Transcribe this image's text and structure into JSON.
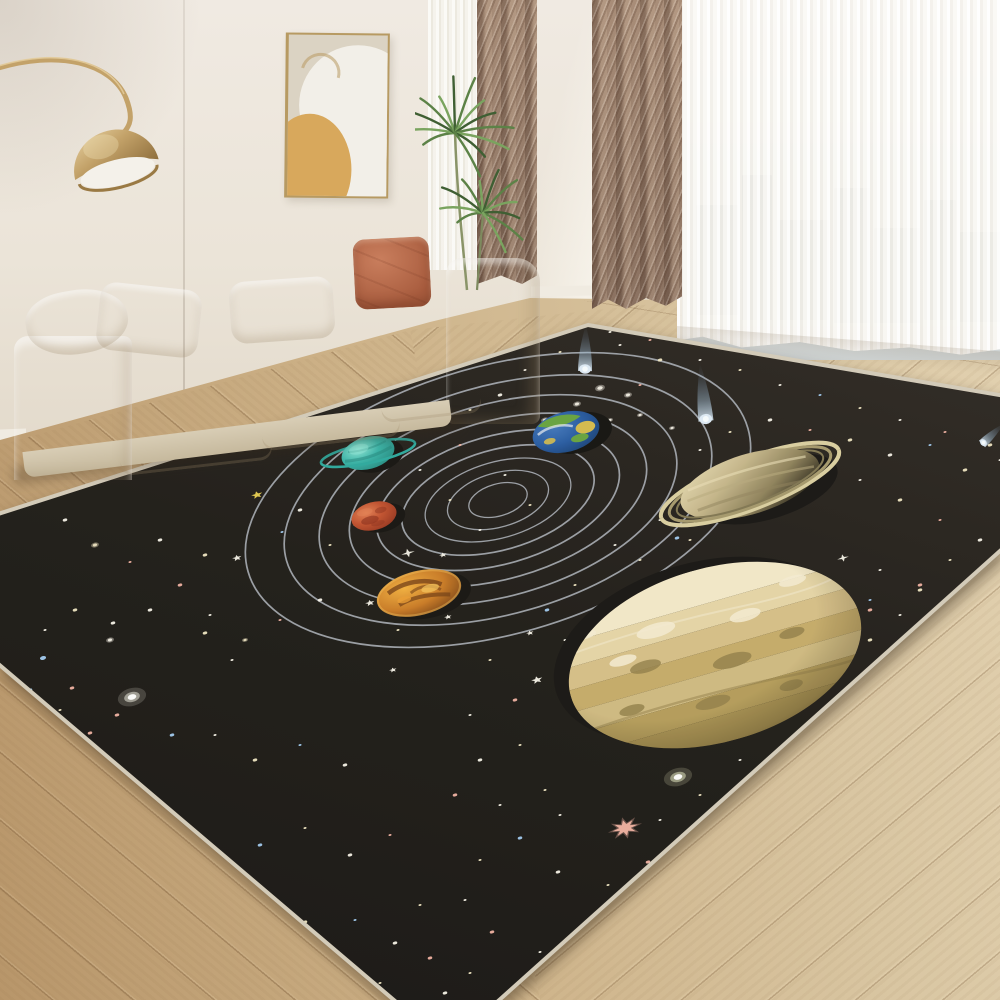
{
  "scene": {
    "kind": "product-photo",
    "subject": "solar-system area rug in a living room",
    "width": 1000,
    "height": 1000
  },
  "palette": {
    "wall1": "#f0eae2",
    "wall2": "#ebe4d8",
    "wall3": "#e2d9ca",
    "baseboard": "#f0ebe1",
    "floorL": "#b8966a",
    "floorM": "#cdb288",
    "floorR": "#d9c6a2",
    "curt1": "#a88d78",
    "curt2": "#8a7160",
    "sheerW": "#f7f5f0",
    "city": "#9aa4ad",
    "sky": "#e9eae8",
    "sofa1": "#f3edе0",
    "sofa2": "#e8e0cd",
    "sofa3": "#d8cdb5",
    "terra1": "#c97e5d",
    "terra2": "#a85c3e",
    "artBg": "#dbd3c3",
    "artWhite": "#f2efe8",
    "artMustard": "#d8a85c",
    "artFrame": "#b79a62",
    "gold1": "#c3a269",
    "gold2": "#8f6f3d",
    "gold3": "#e6d0a0",
    "plant1": "#5c8247",
    "plant2": "#7aa45f",
    "plant3": "#3f5f33"
  },
  "city_buildings": [
    {
      "x": 14,
      "y": 135,
      "w": 42,
      "h": 110
    },
    {
      "x": 60,
      "y": 105,
      "w": 30,
      "h": 145
    },
    {
      "x": 95,
      "y": 150,
      "w": 52,
      "h": 100
    },
    {
      "x": 152,
      "y": 118,
      "w": 36,
      "h": 135
    },
    {
      "x": 192,
      "y": 158,
      "w": 46,
      "h": 95
    },
    {
      "x": 242,
      "y": 130,
      "w": 32,
      "h": 120
    },
    {
      "x": 278,
      "y": 162,
      "w": 40,
      "h": 90
    }
  ],
  "rug": {
    "polygon": [
      [
        588,
        325
      ],
      [
        1146,
        420
      ],
      [
        448,
        1046
      ],
      [
        -130,
        555
      ]
    ],
    "bg_top": "#2a2520",
    "bg_mid": "#1c1914",
    "bg_bot": "#131110",
    "edge_color": "#d3cbb9",
    "edge_width": 4,
    "orbits": {
      "cx": 498,
      "cy": 500,
      "rot": -16,
      "stroke": "#a9aeb6",
      "rings": [
        [
          30,
          16
        ],
        [
          52,
          27
        ],
        [
          75,
          38
        ],
        [
          99,
          50
        ],
        [
          125,
          64
        ],
        [
          153,
          79
        ],
        [
          184,
          96
        ],
        [
          220,
          114
        ],
        [
          260,
          134
        ]
      ]
    },
    "star_colors": {
      "w": "#f7f3e8",
      "c": "#efe6c2",
      "p": "#f0b0a0",
      "b": "#9fc9ef",
      "y": "#e9cf4e",
      "g": "#eef2c9"
    },
    "stars": [
      [
        113,
        623,
        3,
        "w",
        "d"
      ],
      [
        43,
        658,
        4,
        "b",
        "d"
      ],
      [
        72,
        688,
        3,
        "p",
        "d"
      ],
      [
        132,
        697,
        8,
        "w",
        "g"
      ],
      [
        117,
        715,
        3,
        "p",
        "d"
      ],
      [
        172,
        735,
        3,
        "b",
        "d"
      ],
      [
        205,
        633,
        3,
        "c",
        "d"
      ],
      [
        232,
        660,
        2,
        "w",
        "d"
      ],
      [
        110,
        640,
        4,
        "w",
        "b"
      ],
      [
        65,
        520,
        3,
        "w",
        "d"
      ],
      [
        95,
        545,
        4,
        "c",
        "b"
      ],
      [
        130,
        562,
        2,
        "p",
        "d"
      ],
      [
        160,
        540,
        3,
        "w",
        "d"
      ],
      [
        205,
        555,
        3,
        "c",
        "d"
      ],
      [
        237,
        558,
        5,
        "w",
        "s5"
      ],
      [
        257,
        495,
        6,
        "y",
        "s5"
      ],
      [
        282,
        532,
        2,
        "b",
        "d"
      ],
      [
        300,
        510,
        3,
        "w",
        "d"
      ],
      [
        330,
        545,
        2,
        "c",
        "d"
      ],
      [
        355,
        525,
        2,
        "w",
        "d"
      ],
      [
        180,
        585,
        3,
        "p",
        "d"
      ],
      [
        150,
        610,
        3,
        "w",
        "d"
      ],
      [
        75,
        610,
        3,
        "c",
        "d"
      ],
      [
        45,
        630,
        2,
        "w",
        "d"
      ],
      [
        210,
        615,
        2,
        "w",
        "d"
      ],
      [
        245,
        640,
        3,
        "c",
        "b"
      ],
      [
        280,
        620,
        2,
        "p",
        "d"
      ],
      [
        320,
        600,
        3,
        "w",
        "d"
      ],
      [
        370,
        603,
        5,
        "w",
        "s5"
      ],
      [
        398,
        630,
        2,
        "c",
        "d"
      ],
      [
        30,
        690,
        3,
        "b",
        "d"
      ],
      [
        60,
        710,
        2,
        "c",
        "d"
      ],
      [
        90,
        733,
        3,
        "p",
        "d"
      ],
      [
        215,
        735,
        2,
        "w",
        "d"
      ],
      [
        255,
        760,
        3,
        "c",
        "d"
      ],
      [
        300,
        745,
        2,
        "b",
        "d"
      ],
      [
        345,
        765,
        3,
        "w",
        "d"
      ],
      [
        47,
        715,
        3,
        "c",
        "d"
      ],
      [
        85,
        750,
        2,
        "w",
        "d"
      ],
      [
        125,
        780,
        4,
        "c",
        "b"
      ],
      [
        170,
        812,
        3,
        "p",
        "d"
      ],
      [
        215,
        848,
        2,
        "w",
        "d"
      ],
      [
        260,
        845,
        3,
        "b",
        "d"
      ],
      [
        305,
        828,
        2,
        "c",
        "d"
      ],
      [
        350,
        855,
        3,
        "w",
        "d"
      ],
      [
        390,
        835,
        2,
        "p",
        "d"
      ],
      [
        210,
        888,
        2,
        "w",
        "d"
      ],
      [
        258,
        898,
        3,
        "p",
        "d"
      ],
      [
        305,
        922,
        3,
        "c",
        "d"
      ],
      [
        355,
        920,
        2,
        "b",
        "d"
      ],
      [
        395,
        943,
        3,
        "w",
        "d"
      ],
      [
        420,
        905,
        2,
        "c",
        "d"
      ],
      [
        340,
        958,
        3,
        "w",
        "d"
      ],
      [
        380,
        983,
        2,
        "c",
        "d"
      ],
      [
        430,
        958,
        3,
        "p",
        "d"
      ],
      [
        445,
        993,
        3,
        "w",
        "d"
      ],
      [
        470,
        973,
        2,
        "c",
        "d"
      ],
      [
        420,
        470,
        2,
        "w",
        "d"
      ],
      [
        450,
        500,
        2,
        "c",
        "d"
      ],
      [
        480,
        530,
        2,
        "w",
        "d"
      ],
      [
        505,
        475,
        2,
        "w",
        "d"
      ],
      [
        530,
        505,
        2,
        "c",
        "d"
      ],
      [
        460,
        445,
        2,
        "p",
        "d"
      ],
      [
        545,
        420,
        4,
        "w",
        "b"
      ],
      [
        577,
        404,
        4,
        "w",
        "b"
      ],
      [
        600,
        388,
        5,
        "w",
        "b"
      ],
      [
        628,
        395,
        4,
        "w",
        "b"
      ],
      [
        610,
        420,
        3,
        "w",
        "b"
      ],
      [
        500,
        395,
        3,
        "w",
        "d"
      ],
      [
        470,
        410,
        2,
        "c",
        "d"
      ],
      [
        435,
        425,
        2,
        "w",
        "d"
      ],
      [
        525,
        370,
        2,
        "w",
        "d"
      ],
      [
        560,
        352,
        2,
        "c",
        "d"
      ],
      [
        620,
        345,
        2,
        "w",
        "d"
      ],
      [
        660,
        360,
        3,
        "c",
        "d"
      ],
      [
        640,
        385,
        2,
        "p",
        "d"
      ],
      [
        408,
        553,
        7,
        "w",
        "s4"
      ],
      [
        443,
        555,
        4,
        "w",
        "s5"
      ],
      [
        448,
        617,
        4,
        "w",
        "s5"
      ],
      [
        393,
        670,
        4,
        "w",
        "s5"
      ],
      [
        530,
        633,
        4,
        "w",
        "s5"
      ],
      [
        537,
        680,
        6,
        "w",
        "s5"
      ],
      [
        490,
        660,
        2,
        "c",
        "d"
      ],
      [
        515,
        700,
        3,
        "p",
        "d"
      ],
      [
        470,
        715,
        2,
        "w",
        "d"
      ],
      [
        547,
        610,
        3,
        "b",
        "d"
      ],
      [
        575,
        585,
        2,
        "c",
        "d"
      ],
      [
        600,
        610,
        2,
        "w",
        "d"
      ],
      [
        565,
        640,
        2,
        "w",
        "d"
      ],
      [
        700,
        450,
        2,
        "w",
        "d"
      ],
      [
        730,
        432,
        2,
        "c",
        "d"
      ],
      [
        770,
        420,
        3,
        "w",
        "d"
      ],
      [
        810,
        430,
        2,
        "p",
        "d"
      ],
      [
        850,
        440,
        3,
        "c",
        "d"
      ],
      [
        890,
        455,
        3,
        "w",
        "d"
      ],
      [
        930,
        445,
        2,
        "b",
        "d"
      ],
      [
        965,
        470,
        3,
        "c",
        "d"
      ],
      [
        1000,
        460,
        2,
        "w",
        "d"
      ],
      [
        1035,
        475,
        3,
        "p",
        "d"
      ],
      [
        1070,
        490,
        2,
        "w",
        "d"
      ],
      [
        860,
        480,
        2,
        "w",
        "d"
      ],
      [
        900,
        500,
        3,
        "c",
        "d"
      ],
      [
        940,
        520,
        2,
        "p",
        "d"
      ],
      [
        980,
        540,
        3,
        "w",
        "d"
      ],
      [
        1020,
        555,
        2,
        "c",
        "d"
      ],
      [
        843,
        558,
        6,
        "w",
        "s4"
      ],
      [
        880,
        570,
        2,
        "w",
        "d"
      ],
      [
        920,
        590,
        3,
        "c",
        "d"
      ],
      [
        960,
        600,
        2,
        "b",
        "d"
      ],
      [
        1000,
        618,
        3,
        "w",
        "d"
      ],
      [
        870,
        610,
        3,
        "p",
        "d"
      ],
      [
        690,
        540,
        2,
        "c",
        "d"
      ],
      [
        660,
        520,
        2,
        "w",
        "d"
      ],
      [
        677,
        538,
        3,
        "b",
        "d"
      ],
      [
        640,
        560,
        2,
        "c",
        "d"
      ],
      [
        615,
        545,
        2,
        "w",
        "d"
      ],
      [
        480,
        760,
        3,
        "w",
        "d"
      ],
      [
        520,
        745,
        2,
        "c",
        "d"
      ],
      [
        455,
        795,
        3,
        "p",
        "d"
      ],
      [
        500,
        805,
        2,
        "w",
        "d"
      ],
      [
        545,
        790,
        2,
        "c",
        "d"
      ],
      [
        678,
        777,
        8,
        "g",
        "g"
      ],
      [
        625,
        828,
        13,
        "p",
        "s8"
      ],
      [
        560,
        815,
        2,
        "w",
        "d"
      ],
      [
        520,
        838,
        3,
        "b",
        "d"
      ],
      [
        480,
        860,
        2,
        "c",
        "d"
      ],
      [
        558,
        872,
        3,
        "w",
        "d"
      ],
      [
        608,
        885,
        2,
        "c",
        "d"
      ],
      [
        648,
        862,
        3,
        "p",
        "d"
      ],
      [
        588,
        928,
        3,
        "c",
        "d"
      ],
      [
        540,
        952,
        2,
        "w",
        "d"
      ],
      [
        492,
        932,
        3,
        "p",
        "d"
      ],
      [
        465,
        900,
        2,
        "w",
        "d"
      ],
      [
        660,
        820,
        2,
        "w",
        "d"
      ],
      [
        700,
        795,
        2,
        "c",
        "d"
      ],
      [
        740,
        760,
        2,
        "w",
        "d"
      ],
      [
        870,
        640,
        3,
        "c",
        "d"
      ],
      [
        900,
        615,
        2,
        "w",
        "d"
      ],
      [
        920,
        585,
        3,
        "p",
        "d"
      ],
      [
        950,
        560,
        2,
        "c",
        "d"
      ],
      [
        870,
        600,
        2,
        "b",
        "d"
      ],
      [
        560,
        330,
        2,
        "c",
        "d"
      ],
      [
        610,
        332,
        2,
        "w",
        "d"
      ],
      [
        650,
        340,
        2,
        "p",
        "d"
      ],
      [
        700,
        360,
        2,
        "w",
        "d"
      ],
      [
        740,
        370,
        2,
        "c",
        "d"
      ],
      [
        780,
        385,
        2,
        "w",
        "d"
      ],
      [
        820,
        395,
        2,
        "b",
        "d"
      ],
      [
        860,
        408,
        2,
        "c",
        "d"
      ],
      [
        900,
        420,
        2,
        "w",
        "d"
      ],
      [
        945,
        432,
        2,
        "p",
        "d"
      ],
      [
        990,
        445,
        3,
        "c",
        "d"
      ],
      [
        1030,
        455,
        2,
        "w",
        "d"
      ],
      [
        640,
        415,
        3,
        "w",
        "b"
      ],
      [
        672,
        428,
        3,
        "w",
        "b"
      ]
    ],
    "comets": [
      {
        "x": 585,
        "y": 371,
        "len": 46,
        "w": 14,
        "ang": 1
      },
      {
        "x": 706,
        "y": 421,
        "len": 58,
        "w": 15,
        "ang": -6
      },
      {
        "x": 982,
        "y": 444,
        "len": 30,
        "w": 9,
        "ang": 47
      }
    ],
    "planets": [
      {
        "name": "uranus",
        "cx": 368,
        "cy": 453,
        "rx": 27,
        "ry": 16,
        "rot": -15,
        "colors": {
          "base": "#35b0a4",
          "light": "#8ce4d4",
          "dark": "#1f8278",
          "shadow": "#13110e"
        },
        "ring": {
          "rx": 48,
          "ry": 10,
          "rot": 3,
          "color": "#2aa79c",
          "width": 2.6
        }
      },
      {
        "name": "mars",
        "cx": 374,
        "cy": 516,
        "rx": 23,
        "ry": 14,
        "rot": -15,
        "colors": {
          "base": "#bf4e2b",
          "light": "#e07c50",
          "dark": "#8c2e1a",
          "shadow": "#13110e"
        }
      },
      {
        "name": "venus",
        "cx": 419,
        "cy": 593,
        "rx": 43,
        "ry": 22,
        "rot": -14,
        "colors": {
          "base": "#c67722",
          "light": "#f0ad3c",
          "dark": "#6f3a10",
          "glow": "#f6c45a",
          "shadow": "#13110e"
        }
      },
      {
        "name": "earth",
        "cx": 566,
        "cy": 432,
        "rx": 34,
        "ry": 20,
        "rot": -14,
        "colors": {
          "ocean": "#2559a0",
          "ocean2": "#143a6e",
          "land": "#64a13c",
          "land2": "#d3b94a",
          "cloud": "#e9edf0",
          "shadow": "#11100d"
        }
      },
      {
        "name": "saturn",
        "cx": 750,
        "cy": 484,
        "rx": 72,
        "ry": 30,
        "rot": -17,
        "colors": {
          "light": "#e8dcb4",
          "base": "#c3b488",
          "mid": "#8d8059",
          "dark": "#2c2719",
          "shadow": "#141210"
        },
        "rings": [
          [
            95,
            25,
            "#d8cc9e",
            4
          ],
          [
            86,
            22.5,
            "#a3966a",
            3
          ],
          [
            78,
            20,
            "#7e7450",
            2
          ]
        ],
        "ringRot": -4
      },
      {
        "name": "jupiter",
        "cx": 715,
        "cy": 655,
        "rx": 150,
        "ry": 87,
        "rot": -16,
        "colors": {
          "b1": "#f1e6c6",
          "b2": "#e3d3a4",
          "b3": "#d4bd85",
          "b4": "#c3a967",
          "b3b": "#cdb87e",
          "b5": "#b29a58",
          "b4b": "#a89150",
          "blobD": "#8f7c46",
          "blobL": "#f3ead0",
          "shadow": "#141210"
        }
      }
    ]
  }
}
